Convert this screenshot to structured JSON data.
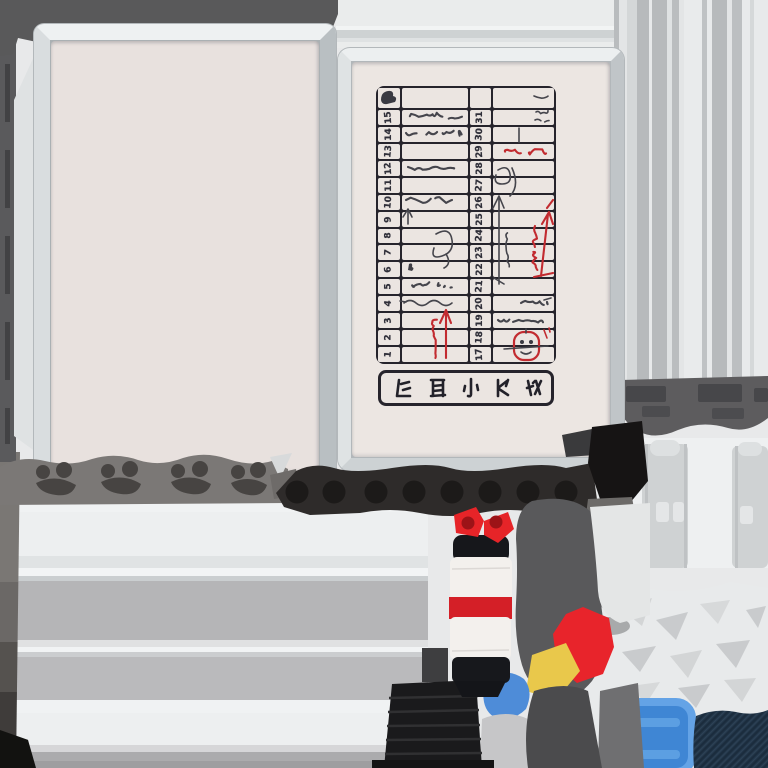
{
  "texture_atlas": {
    "name": "whiteboard-calendar-prop-texture",
    "calendar": {
      "col1_days": [
        "15",
        "14",
        "13",
        "12",
        "11",
        "10",
        "9",
        "8",
        "7",
        "6",
        "5",
        "4",
        "3",
        "2",
        "1"
      ],
      "col2_days": [
        "31",
        "30",
        "29",
        "28",
        "27",
        "26",
        "25",
        "24",
        "23",
        "22",
        "21",
        "20",
        "19",
        "18",
        "17"
      ],
      "header_glyph_count": 1,
      "title_glyph_count": 5,
      "grid_color": "#26242c",
      "paper_color": "#ece6e2",
      "ink_color": "#30303a",
      "red_ink_color": "#c22b30",
      "annotations": [
        {
          "name": "scribble-line",
          "row": "15",
          "column": "left-notes",
          "color": "gray"
        },
        {
          "name": "scribble-line",
          "row": "14",
          "column": "left-notes",
          "color": "gray"
        },
        {
          "name": "scribble-line",
          "row": "12",
          "column": "left-notes",
          "color": "gray"
        },
        {
          "name": "scribble-line",
          "row": "10",
          "column": "left-notes",
          "color": "gray"
        },
        {
          "name": "small-up-arrow",
          "row": "9",
          "column": "left-notes",
          "color": "gray"
        },
        {
          "name": "loop-doodle",
          "row": "8-7",
          "column": "left-notes",
          "color": "gray"
        },
        {
          "name": "small-mark",
          "row": "6",
          "column": "left-notes",
          "color": "gray"
        },
        {
          "name": "scribble-line",
          "row": "5",
          "column": "left-notes",
          "color": "gray"
        },
        {
          "name": "wavy-line",
          "row": "4",
          "column": "left-notes",
          "color": "gray"
        },
        {
          "name": "vertical-note-with-up-arrow",
          "row": "3-1",
          "column": "left-notes",
          "color": "red"
        },
        {
          "name": "glyph-cluster",
          "row": "header-31",
          "column": "right-notes",
          "color": "gray"
        },
        {
          "name": "vertical-tick",
          "row": "30",
          "column": "right-notes",
          "color": "gray"
        },
        {
          "name": "scribble-word",
          "row": "29",
          "column": "right-notes",
          "color": "red"
        },
        {
          "name": "loop-doodle",
          "row": "28-27",
          "column": "right-notes",
          "color": "gray"
        },
        {
          "name": "long-up-arrow",
          "row": "26-20",
          "column": "right-notes",
          "color": "gray"
        },
        {
          "name": "vertical-marks",
          "row": "25-23",
          "column": "right-notes",
          "color": "gray"
        },
        {
          "name": "vertical-note-with-up-arrow",
          "row": "24-22",
          "column": "right-notes",
          "color": "red"
        },
        {
          "name": "scribble-line",
          "row": "20",
          "column": "right-notes",
          "color": "gray"
        },
        {
          "name": "scribble-line",
          "row": "19",
          "column": "right-notes",
          "color": "gray"
        },
        {
          "name": "circled-glyph",
          "row": "18-17",
          "column": "right-notes",
          "color": "red"
        }
      ]
    },
    "tray": {
      "hole_count": 8,
      "base_color": "#2e2b2a",
      "hole_color": "#1c1a19"
    },
    "paw_pads": {
      "cluster_count": 4,
      "color": "#474442"
    },
    "marker_pen": {
      "cap_color": "#17181c",
      "body_color": "#f3f0ed",
      "band_color": "#d41f27"
    },
    "patches": {
      "bowtie_red": "#e62428",
      "patch_red": "#e8242b",
      "patch_yellow": "#e9c84b",
      "patch_blue": "#4e8cd8",
      "plate_blue": "#3f86d4",
      "plate_blue_rim": "#64a3e6",
      "denim_navy": "#223649"
    },
    "palette": {
      "background": "#e8e9ea",
      "frame_silver": "#d9dddf",
      "trim_dark": "#59595a",
      "board_surface": "#e8e1de",
      "pillar_gray": "#b7babc",
      "shelf_gray": "#b5b5b7",
      "cap_band": "#5d5c5e",
      "step_block": "#1a1a1c"
    }
  }
}
